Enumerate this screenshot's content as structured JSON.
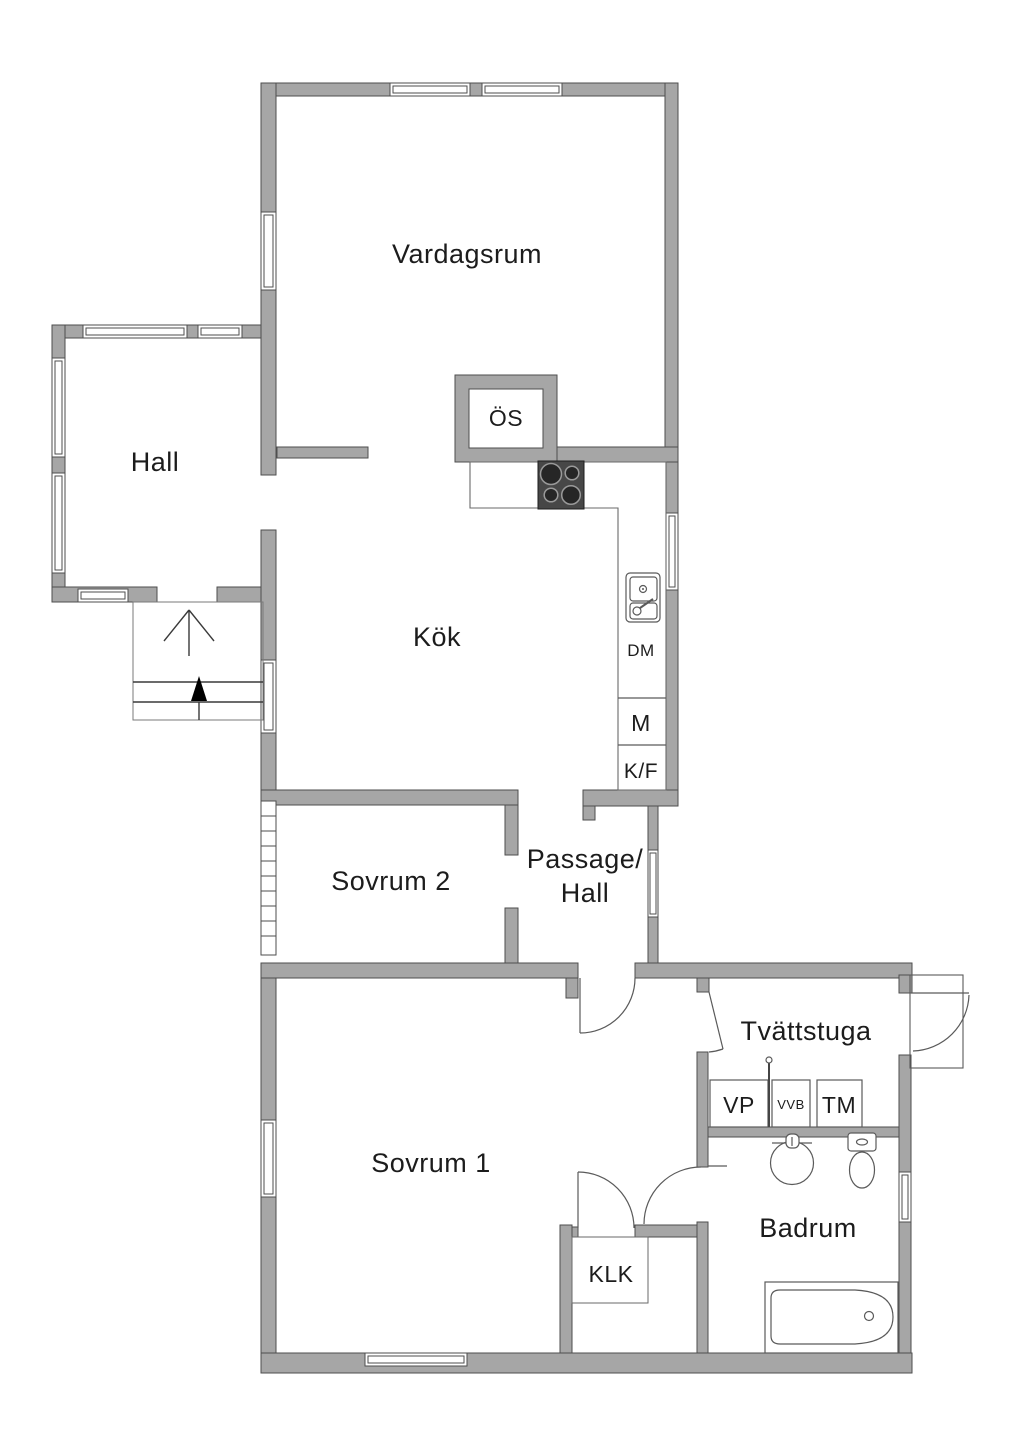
{
  "rooms": {
    "vardagsrum": "Vardagsrum",
    "hall": "Hall",
    "kok": "Kök",
    "os": "ÖS",
    "sovrum2": "Sovrum 2",
    "passage_line1": "Passage/",
    "passage_line2": "Hall",
    "sovrum1": "Sovrum 1",
    "tvattstuga": "Tvättstuga",
    "badrum": "Badrum",
    "klk": "KLK"
  },
  "appliances": {
    "dm": "DM",
    "m": "M",
    "kf": "K/F",
    "vp": "VP",
    "vvb": "VVB",
    "tm": "TM"
  },
  "colors": {
    "wall": "#a6a6a6",
    "wall-outline": "#4e4e4e",
    "text": "#1c1c1c",
    "stove-body": "#474747",
    "burner": "#262626",
    "burner-ring": "#9a9a9a",
    "background": "#ffffff"
  }
}
